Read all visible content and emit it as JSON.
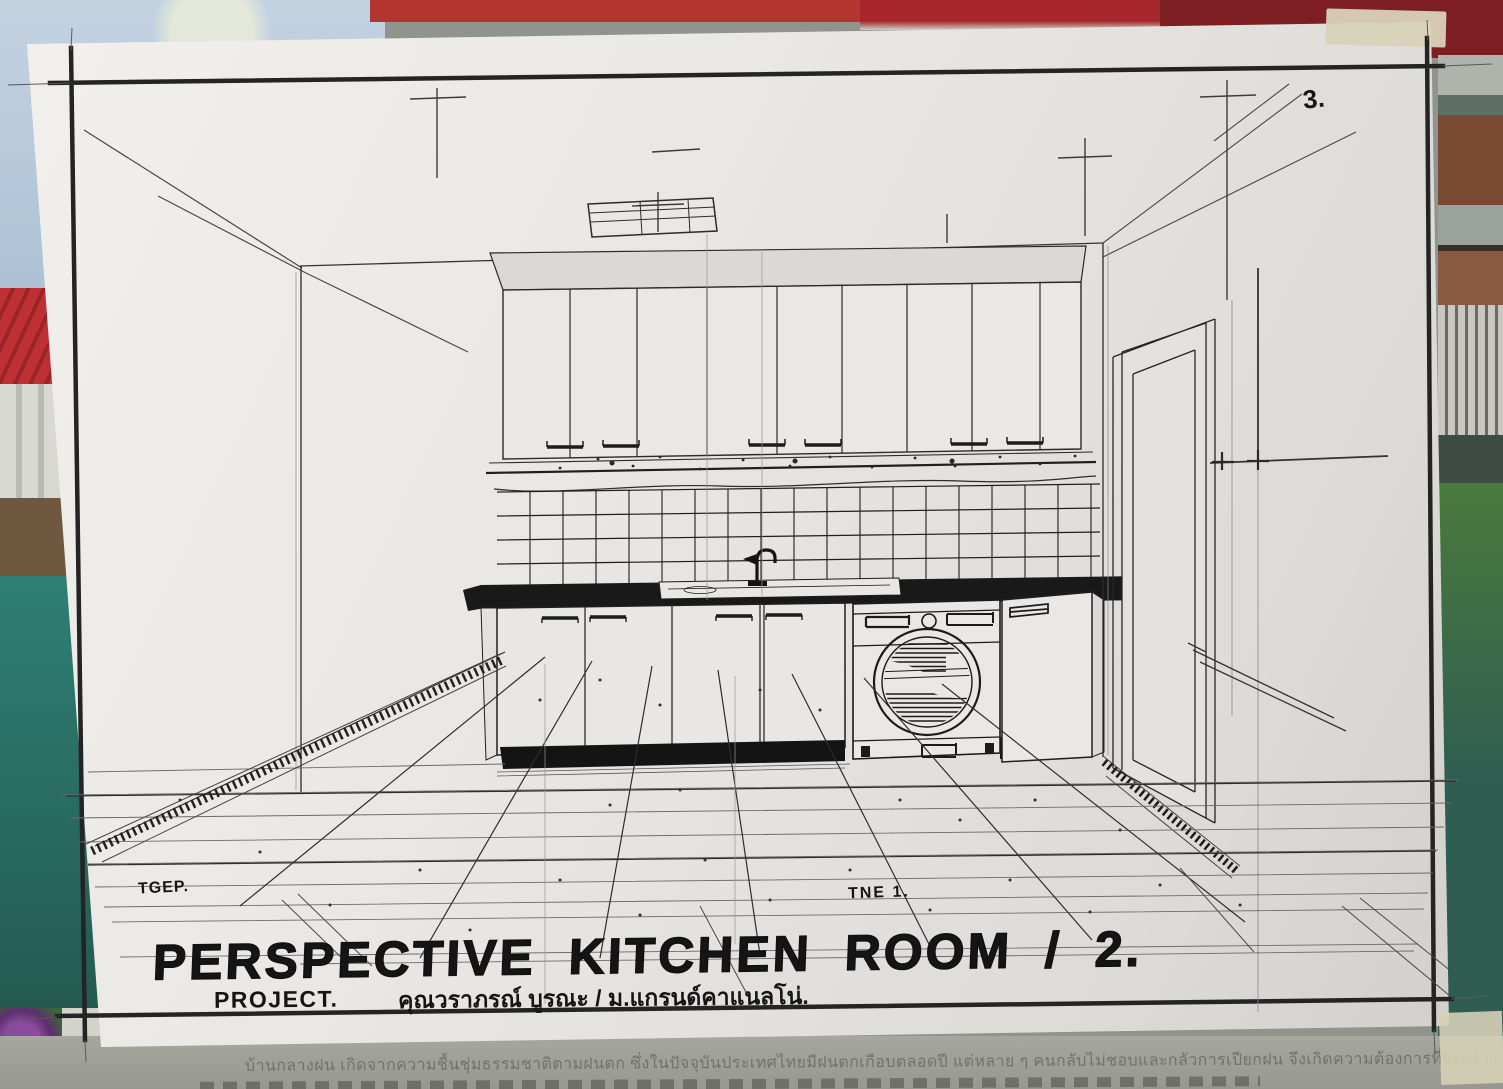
{
  "sheet": {
    "page_number": "3.",
    "title": "PERSPECTIVE KITCHEN ROOM / 2.",
    "project_label": "PROJECT.",
    "project_value": "คุณวราภรณ์ บูรณะ / ม.แกรนด์คาแนลโน่.",
    "initials": "TGEP.",
    "note": "TNE 1."
  },
  "background": {
    "caption": "บ้านกลางฝน เกิดจากความชื้นชุ่มธรรมชาติตามฝนตก ซึ่งในปัจจุบันประเทศไทยมีฝนตกเกือบตลอดปี แต่หลาย ๆ คนกลับไม่ชอบและกลัวการเปียกฝน จึงเกิดความต้องการที่จะสร้าง"
  },
  "colors": {
    "ink": "#222222",
    "pencil": "#7a7a77",
    "paper": "#eae8e4",
    "counter_fill": "#191919",
    "tape": "#d9d2b9",
    "roof_red": "#bf3034",
    "water_teal": "#2c7a70",
    "caption_text": "#6f746a"
  }
}
